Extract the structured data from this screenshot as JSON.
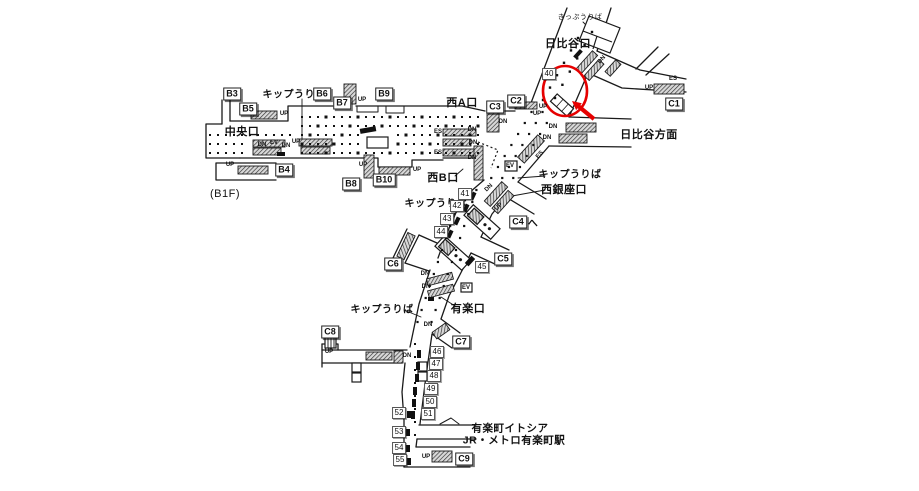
{
  "floor_note": "(B1F)",
  "colors": {
    "line": "#1a1a1a",
    "highlight": "#e60000",
    "background": "#ffffff"
  },
  "exits": [
    {
      "label": "B3",
      "x": 232,
      "y": 94
    },
    {
      "label": "B5",
      "x": 248,
      "y": 109
    },
    {
      "label": "B6",
      "x": 322,
      "y": 94
    },
    {
      "label": "B7",
      "x": 342,
      "y": 103
    },
    {
      "label": "B9",
      "x": 384,
      "y": 94
    },
    {
      "label": "B4",
      "x": 284,
      "y": 170
    },
    {
      "label": "B8",
      "x": 351,
      "y": 184
    },
    {
      "label": "B10",
      "x": 384,
      "y": 180
    },
    {
      "label": "C1",
      "x": 674,
      "y": 104
    },
    {
      "label": "C2",
      "x": 516,
      "y": 101
    },
    {
      "label": "C3",
      "x": 495,
      "y": 107
    },
    {
      "label": "C4",
      "x": 518,
      "y": 222
    },
    {
      "label": "C5",
      "x": 503,
      "y": 259
    },
    {
      "label": "C6",
      "x": 393,
      "y": 264
    },
    {
      "label": "C7",
      "x": 461,
      "y": 342
    },
    {
      "label": "C8",
      "x": 330,
      "y": 332
    },
    {
      "label": "C9",
      "x": 464,
      "y": 459
    }
  ],
  "ads": [
    {
      "label": "40",
      "x": 549,
      "y": 74
    },
    {
      "label": "41",
      "x": 465,
      "y": 194
    },
    {
      "label": "42",
      "x": 457,
      "y": 206
    },
    {
      "label": "43",
      "x": 447,
      "y": 219
    },
    {
      "label": "44",
      "x": 441,
      "y": 232
    },
    {
      "label": "45",
      "x": 482,
      "y": 267
    },
    {
      "label": "46",
      "x": 437,
      "y": 352
    },
    {
      "label": "47",
      "x": 436,
      "y": 364
    },
    {
      "label": "48",
      "x": 434,
      "y": 376
    },
    {
      "label": "49",
      "x": 431,
      "y": 389
    },
    {
      "label": "50",
      "x": 430,
      "y": 402
    },
    {
      "label": "51",
      "x": 428,
      "y": 414
    },
    {
      "label": "52",
      "x": 399,
      "y": 413
    },
    {
      "label": "53",
      "x": 399,
      "y": 432
    },
    {
      "label": "54",
      "x": 399,
      "y": 448
    },
    {
      "label": "55",
      "x": 400,
      "y": 460
    }
  ],
  "area_labels": [
    {
      "name": "label-ticket-office-top",
      "text": "きっぷうりば",
      "x": 580,
      "y": 17,
      "size": 7,
      "bold": false
    },
    {
      "name": "label-hibiya-exit",
      "text": "日比谷口",
      "x": 568,
      "y": 43,
      "size": 11,
      "bold": true
    },
    {
      "name": "label-hibiya-direction",
      "text": "日比谷方面",
      "x": 649,
      "y": 134,
      "size": 11,
      "bold": true
    },
    {
      "name": "label-ticket-office-west",
      "text": "キップうりば",
      "x": 294,
      "y": 93,
      "size": 10,
      "bold": true
    },
    {
      "name": "label-central-exit",
      "text": "中央口",
      "x": 242,
      "y": 131,
      "size": 11,
      "bold": true
    },
    {
      "name": "label-west-a-exit",
      "text": "西A口",
      "x": 462,
      "y": 102,
      "size": 11,
      "bold": true
    },
    {
      "name": "label-west-b-exit",
      "text": "西B口",
      "x": 443,
      "y": 177,
      "size": 11,
      "bold": true
    },
    {
      "name": "label-ticket-office-nishiginza",
      "text": "キップうりば",
      "x": 570,
      "y": 173,
      "size": 10,
      "bold": true
    },
    {
      "name": "label-nishiginza-exit",
      "text": "西銀座口",
      "x": 564,
      "y": 189,
      "size": 11,
      "bold": true
    },
    {
      "name": "label-ticket-office-mid",
      "text": "キップうりば",
      "x": 436,
      "y": 202,
      "size": 10,
      "bold": true
    },
    {
      "name": "label-to-c4",
      "text": "へ",
      "x": 533,
      "y": 222,
      "size": 10,
      "bold": true
    },
    {
      "name": "label-yuraku-exit",
      "text": "有楽口",
      "x": 468,
      "y": 308,
      "size": 11,
      "bold": true
    },
    {
      "name": "label-ticket-office-south",
      "text": "キップうりば",
      "x": 382,
      "y": 308,
      "size": 10,
      "bold": true
    },
    {
      "name": "label-yurakucho-itocia",
      "text": "有楽町イトシア",
      "x": 510,
      "y": 428,
      "size": 10.5,
      "bold": true
    },
    {
      "name": "label-jr-metro-yurakucho",
      "text": "JR・メトロ有楽町駅",
      "x": 514,
      "y": 440,
      "size": 10.5,
      "bold": true
    },
    {
      "name": "label-floor",
      "text": "(B1F)",
      "x": 225,
      "y": 194,
      "size": 11,
      "bold": false
    }
  ],
  "tiny_labels": [
    {
      "text": "UP",
      "x": 284,
      "y": 114,
      "rot": 0
    },
    {
      "text": "UP",
      "x": 362,
      "y": 100,
      "rot": 0
    },
    {
      "text": "UP",
      "x": 230,
      "y": 165,
      "rot": 0
    },
    {
      "text": "UP",
      "x": 363,
      "y": 165,
      "rot": 0
    },
    {
      "text": "UP",
      "x": 417,
      "y": 170,
      "rot": 0
    },
    {
      "text": "DN",
      "x": 262,
      "y": 145,
      "rot": 0
    },
    {
      "text": "EV",
      "x": 274,
      "y": 143,
      "rot": 0
    },
    {
      "text": "DN",
      "x": 286,
      "y": 146,
      "rot": 0
    },
    {
      "text": "UP",
      "x": 296,
      "y": 142,
      "rot": 0
    },
    {
      "text": "ES",
      "x": 438,
      "y": 132,
      "rot": 0
    },
    {
      "text": "DN",
      "x": 472,
      "y": 130,
      "rot": 0
    },
    {
      "text": "DN",
      "x": 473,
      "y": 143,
      "rot": 0
    },
    {
      "text": "ES",
      "x": 438,
      "y": 153,
      "rot": 0
    },
    {
      "text": "DN",
      "x": 472,
      "y": 158,
      "rot": 0
    },
    {
      "text": "DN",
      "x": 503,
      "y": 122,
      "rot": 0
    },
    {
      "text": "UP",
      "x": 543,
      "y": 107,
      "rot": 0
    },
    {
      "text": "UP",
      "x": 537,
      "y": 114,
      "rot": 0
    },
    {
      "text": "DN",
      "x": 602,
      "y": 60,
      "rot": -48
    },
    {
      "text": "ES",
      "x": 673,
      "y": 79,
      "rot": 0
    },
    {
      "text": "UP",
      "x": 649,
      "y": 88,
      "rot": 0
    },
    {
      "text": "DN",
      "x": 553,
      "y": 127,
      "rot": 0
    },
    {
      "text": "DN",
      "x": 547,
      "y": 138,
      "rot": 0
    },
    {
      "text": "ES",
      "x": 540,
      "y": 155,
      "rot": -48
    },
    {
      "text": "EV",
      "x": 510,
      "y": 166,
      "rot": 0
    },
    {
      "text": "DN",
      "x": 489,
      "y": 188,
      "rot": -45
    },
    {
      "text": "UP",
      "x": 499,
      "y": 207,
      "rot": -45
    },
    {
      "text": "EV",
      "x": 466,
      "y": 288,
      "rot": 0
    },
    {
      "text": "DN",
      "x": 425,
      "y": 274,
      "rot": 0
    },
    {
      "text": "DN",
      "x": 426,
      "y": 287,
      "rot": 0
    },
    {
      "text": "DN",
      "x": 428,
      "y": 325,
      "rot": 0
    },
    {
      "text": "UP",
      "x": 329,
      "y": 352,
      "rot": 0
    },
    {
      "text": "DN",
      "x": 407,
      "y": 356,
      "rot": 0
    },
    {
      "text": "UP",
      "x": 426,
      "y": 457,
      "rot": 0
    }
  ],
  "highlight": {
    "color": "#e60000",
    "circle": {
      "cx": 565,
      "cy": 91,
      "rx": 22,
      "ry": 25
    },
    "arrow": {
      "tail_x": 594,
      "tail_y": 119,
      "tip_x": 572,
      "tip_y": 101
    }
  }
}
